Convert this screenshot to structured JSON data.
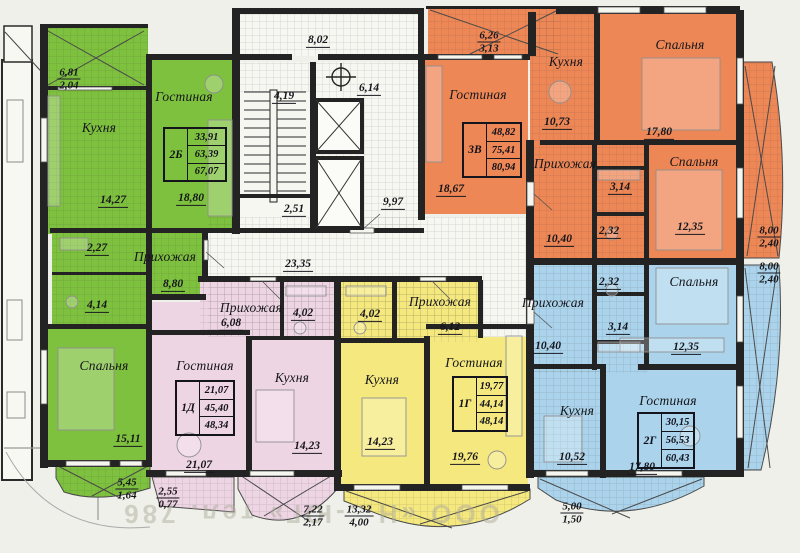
{
  "colors": {
    "green": "#7ec13e",
    "pink": "#eed5e4",
    "yellow": "#f4e87e",
    "orange": "#ee8756",
    "blue": "#abd4ec",
    "wall": "#232323",
    "white_room": "#f7f7f2"
  },
  "core": {
    "upper_hall_area": "8,02",
    "stairs_area": "4,19",
    "lift_lobby_area": "6,14",
    "vestibule_area": "2,51",
    "hall_area": "9,97",
    "corridor_area": "23,35"
  },
  "apartments": {
    "a2b": {
      "table": {
        "type": "2Б",
        "rows": [
          "33,91",
          "63,39",
          "67,07"
        ]
      },
      "kitchen": "Кухня",
      "kitchen_area": "14,27",
      "living": "Гостиная",
      "living_area": "18,80",
      "hall": "Прихожая",
      "hall_area": "8,80",
      "bedroom": "Спальня",
      "bedroom_area": "15,11",
      "wc_area": "2,27",
      "bath_area": "4,14",
      "balcony_top": {
        "t": "6,81",
        "b": "2,04"
      },
      "balcony_bottom": {
        "t": "5,45",
        "b": "1,64"
      }
    },
    "a1d": {
      "table": {
        "type": "1Д",
        "rows": [
          "21,07",
          "45,40",
          "48,34"
        ]
      },
      "hall": "Прихожая",
      "hall_area": "6,08",
      "bath_area": "4,02",
      "living": "Гостиная",
      "living_area": "21,07",
      "kitchen": "Кухня",
      "kitchen_area": "14,23",
      "ledge": {
        "t": "2,55",
        "b": "0,77"
      },
      "balcony": {
        "t": "7,22",
        "b": "2,17"
      }
    },
    "a1g": {
      "table": {
        "type": "1Г",
        "rows": [
          "19,77",
          "44,14",
          "48,14"
        ]
      },
      "hall": "Прихожая",
      "hall_area": "6,12",
      "bath_area": "4,02",
      "kitchen": "Кухня",
      "kitchen_area": "14,23",
      "living": "Гостиная",
      "living_area": "19,76",
      "balcony": {
        "t": "13,32",
        "b": "4,00"
      }
    },
    "a3v": {
      "table": {
        "type": "3В",
        "rows": [
          "48,82",
          "75,41",
          "80,94"
        ]
      },
      "living": "Гостиная",
      "living_area": "18,67",
      "kitchen": "Кухня",
      "kitchen_area": "10,73",
      "hall": "Прихожая",
      "hall_area": "10,40",
      "bedroom1": "Спальня",
      "bedroom1_area": "17,80",
      "bedroom2": "Спальня",
      "bedroom2_area": "12,35",
      "bath_area": "3,14",
      "wc_area": "2,32",
      "balcony_top": {
        "t": "6,26",
        "b": "3,13"
      },
      "balcony_right": {
        "t": "8,00",
        "b": "2,40"
      }
    },
    "a2g": {
      "table": {
        "type": "2Г",
        "rows": [
          "30,15",
          "56,53",
          "60,43"
        ]
      },
      "hall": "Прихожая",
      "hall_area": "10,40",
      "wc_area": "2,32",
      "bath_area": "3,14",
      "bedroom": "Спальня",
      "bedroom_area": "12,35",
      "living": "Гостиная",
      "living_area": "17,80",
      "kitchen": "Кухня",
      "kitchen_area": "10,52",
      "balcony_right": {
        "t": "8,00",
        "b": "2,40"
      },
      "balcony_bottom": {
        "t": "5,00",
        "b": "1,50"
      }
    }
  },
  "watermark": "ООО «Н…-ЮГ» тел. 786"
}
